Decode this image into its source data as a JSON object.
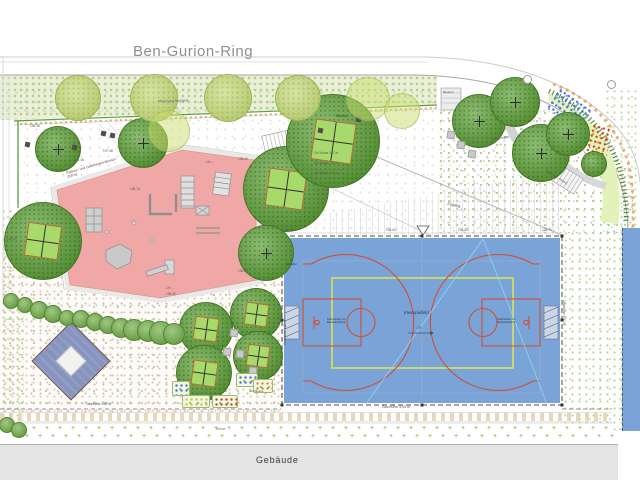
{
  "street": {
    "name": "Ben-Gurion-Ring"
  },
  "building": {
    "label": "Gebäude"
  },
  "meadow": {
    "label": "Wiese",
    "mark": "+"
  },
  "areas": {
    "hedge_note": "Pflanzung Bestand",
    "playground_title": "Parkour- und Calisthenics-Bereich",
    "playground_area": "220 m²",
    "boule": "Boccia",
    "access": "Zugang",
    "hammock": "Hängematte",
    "stairs": "Treppe (11 Stufen)",
    "existing": "Bestand",
    "raised_beds": "Hochbeete",
    "south_fence": "Zaunhöhe 2,00 m"
  },
  "court": {
    "label": "Kleinspielfeld",
    "slope": "2%",
    "goal_line1": "Kleinfeldtor mit",
    "goal_line2": "Basketballkorb",
    "fence_bottom": "Zaunhöhe 4,00 m",
    "fence_left": "Zaunhöhe 4,00 m",
    "fence_right": "Zaunhöhe 4,00 m",
    "gate": "Einzeltür"
  },
  "annotations": [
    {
      "t": "136.98",
      "x": 30,
      "y": 124
    },
    {
      "t": "137.48",
      "x": 103,
      "y": 149
    },
    {
      "t": "136.46",
      "x": 74,
      "y": 158
    },
    {
      "t": "136.43",
      "x": 238,
      "y": 157
    },
    {
      "t": "136.74",
      "x": 130,
      "y": 187
    },
    {
      "t": "136.06",
      "x": 7,
      "y": 237
    },
    {
      "t": "136.26",
      "x": 238,
      "y": 269
    },
    {
      "t": "136.30",
      "x": 166,
      "y": 292
    },
    {
      "t": "OK Mauer 137 m",
      "x": 314,
      "y": 151
    },
    {
      "t": "OK Mauer 137 m",
      "x": 314,
      "y": 161
    },
    {
      "t": "OK Mauer 137 m",
      "x": 314,
      "y": 171
    },
    {
      "t": "136.63",
      "x": 386,
      "y": 228
    },
    {
      "t": "136.38",
      "x": 458,
      "y": 228
    },
    {
      "t": "136.28",
      "x": 284,
      "y": 228
    },
    {
      "t": "135.74",
      "x": 542,
      "y": 228
    },
    {
      "t": "1% →",
      "x": 206,
      "y": 160
    },
    {
      "t": "1% →",
      "x": 166,
      "y": 286
    }
  ],
  "colors": {
    "court_blue": "#7aa3d8",
    "playground_pink": "#efa8a6",
    "tree_green": "#61a23c",
    "court_line_red": "#cf5030",
    "court_line_lime": "#d9e455",
    "building_gray": "#e4e4e4"
  }
}
